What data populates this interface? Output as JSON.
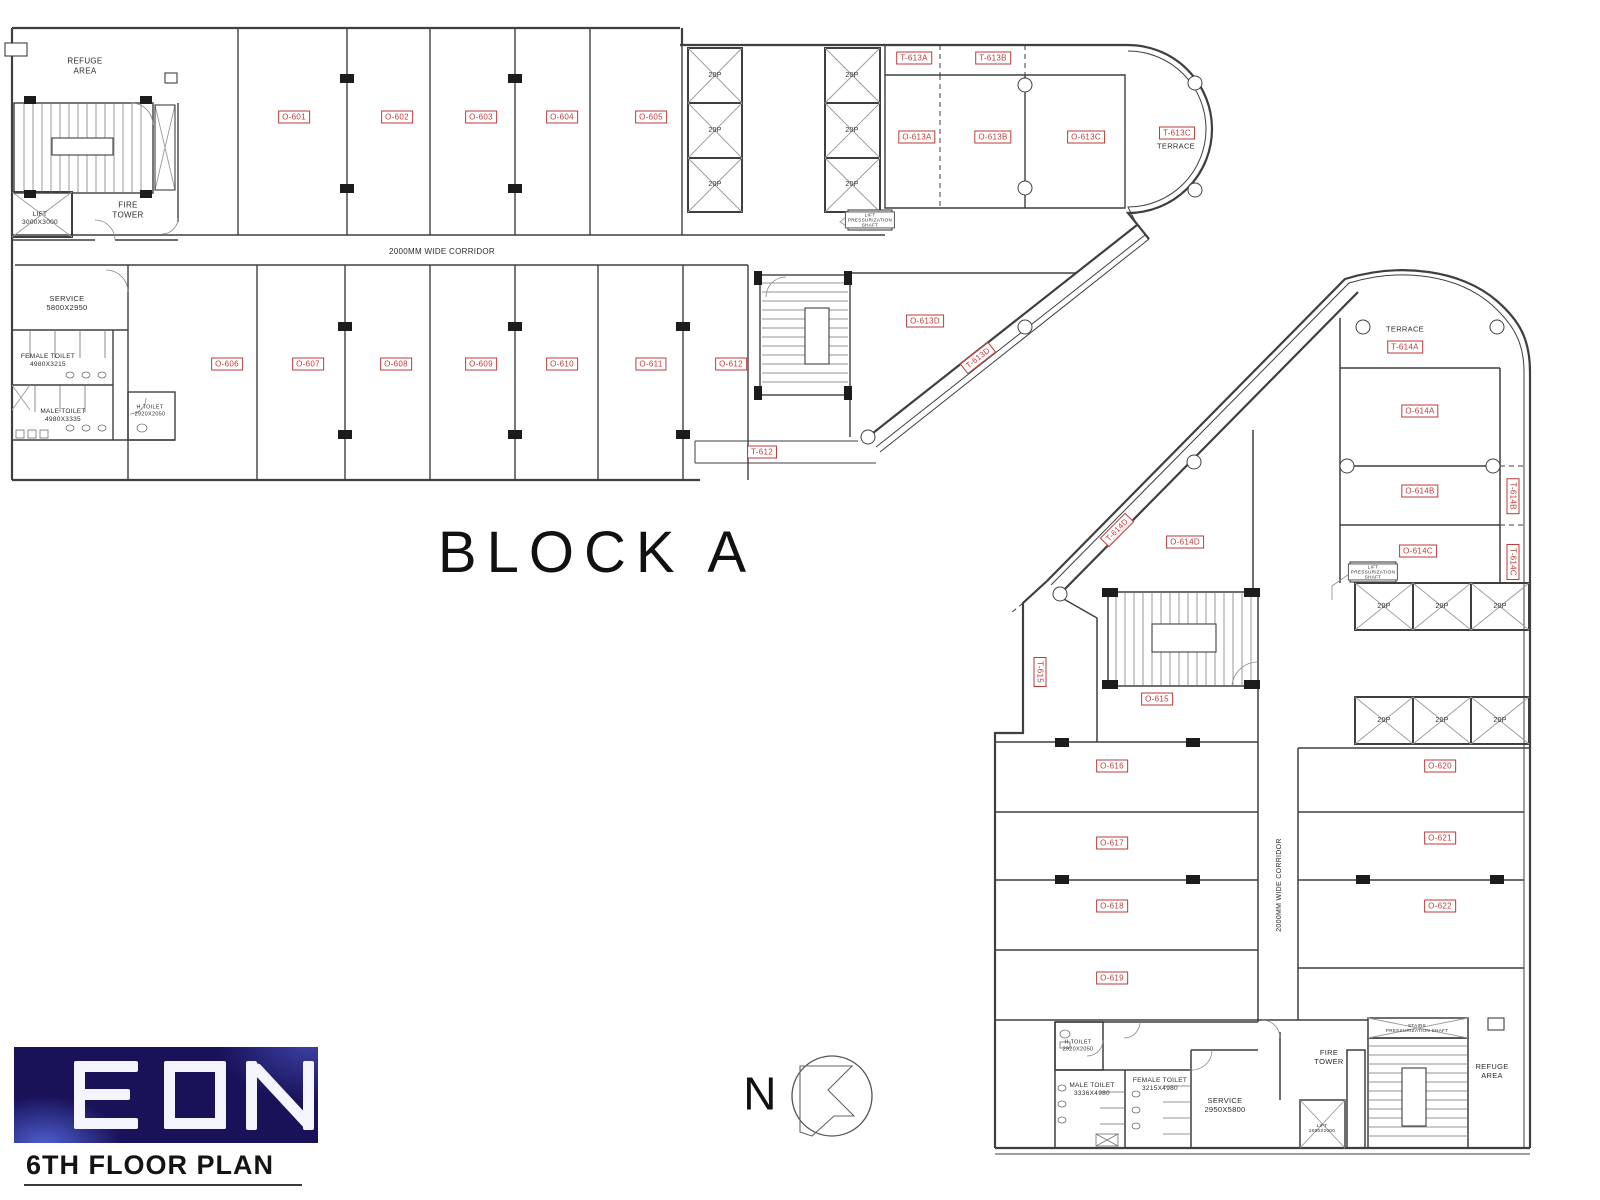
{
  "titles": {
    "block_a": "BLOCK A",
    "floor": "6TH FLOOR PLAN",
    "logo": "EON",
    "north": "N"
  },
  "corridor": {
    "top": "2000MM WIDE CORRIDOR",
    "bottom": "2000MM WIDE CORRIDOR"
  },
  "lift": {
    "capacity": "20P",
    "top_lift": "LIFT\n3000X3000",
    "bottom_lift": "LIFT\n2000X2000",
    "press": "LIFT\nPRESSURIZATION\nSHAFT",
    "stairs_press": "STAIRS\nPRESSURIZATION SHAFT"
  },
  "areas_top": {
    "refuge": "REFUGE\nAREA",
    "fire_tower": "FIRE\nTOWER",
    "service": "SERVICE\n5800X2950",
    "female_toilet": "FEMALE TOILET\n4980X3215",
    "male_toilet": "MALE TOILET\n4980X3335",
    "h_toilet": "H.TOILET\n2920X2050",
    "terrace": "TERRACE"
  },
  "areas_bottom": {
    "refuge": "REFUGE\nAREA",
    "fire_tower": "FIRE\nTOWER",
    "service": "SERVICE\n2950X5800",
    "female_toilet": "FEMALE TOILET\n3215X4980",
    "male_toilet": "MALE TOILET\n3336X4980",
    "h_toilet": "H.TOILET\n2920X2050",
    "terrace": "TERRACE"
  },
  "rooms": {
    "o601": "O-601",
    "o602": "O-602",
    "o603": "O-603",
    "o604": "O-604",
    "o605": "O-605",
    "o606": "O-606",
    "o607": "O-607",
    "o608": "O-608",
    "o609": "O-609",
    "o610": "O-610",
    "o611": "O-611",
    "o612": "O-612",
    "o613a": "O-613A",
    "o613b": "O-613B",
    "o613c": "O-613C",
    "o613d": "O-613D",
    "o614a": "O-614A",
    "o614b": "O-614B",
    "o614c": "O-614C",
    "o614d": "O-614D",
    "o615": "O-615",
    "o616": "O-616",
    "o617": "O-617",
    "o618": "O-618",
    "o619": "O-619",
    "o620": "O-620",
    "o621": "O-621",
    "o622": "O-622"
  },
  "terraces": {
    "t612": "T-612",
    "t613a": "T-613A",
    "t613b": "T-613B",
    "t613c": "T-613C",
    "t613d": "T-613D",
    "t614a": "T-614A",
    "t614b": "T-614B",
    "t614c": "T-614C",
    "t614d": "T-614D",
    "t615": "T-615"
  },
  "colors": {
    "label_red": "#bf3a3a",
    "line": "#3f3f3f",
    "logo_bg": "#191259"
  }
}
